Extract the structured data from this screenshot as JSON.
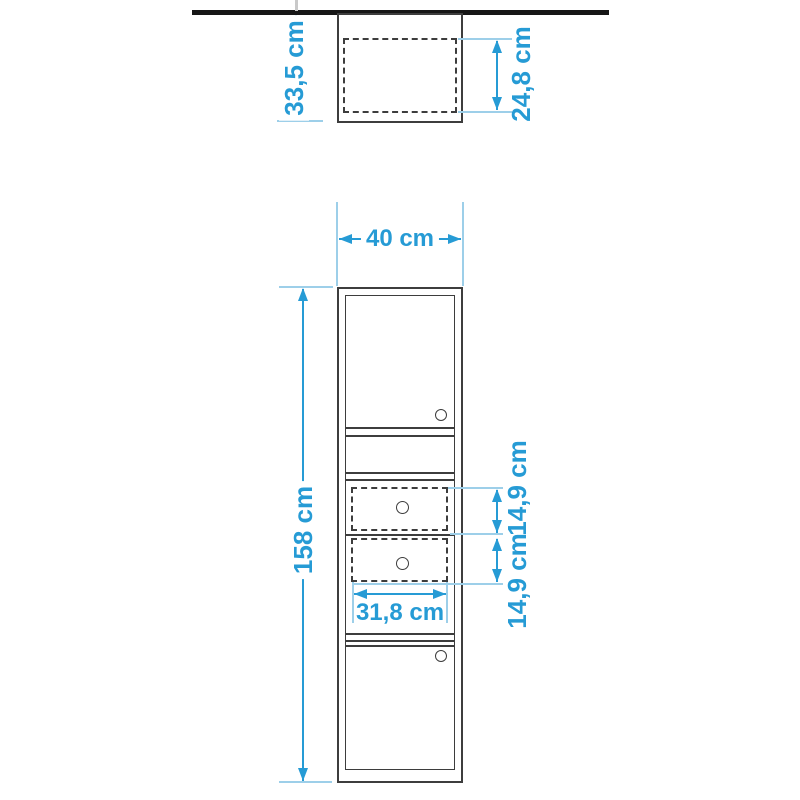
{
  "diagram": {
    "type": "furniture-dimension-drawing",
    "views": [
      "top-view",
      "front-view"
    ],
    "top_view": {
      "depth_label": "33,5 cm",
      "recess_depth_label": "24,8 cm"
    },
    "front_view": {
      "width_label": "40 cm",
      "height_label": "158 cm",
      "upper_drawer_height_label": "14,9 cm",
      "lower_drawer_height_label": "14,9 cm",
      "drawer_width_label": "31,8 cm",
      "parts": [
        "upper-door",
        "open-shelf",
        "upper-drawer",
        "lower-drawer",
        "lower-door"
      ]
    },
    "colors": {
      "dimension": "#269bd5",
      "extension": "#9dcfe9",
      "structure": "#3d3d3d",
      "wall": "#161616",
      "background": "#ffffff"
    }
  }
}
